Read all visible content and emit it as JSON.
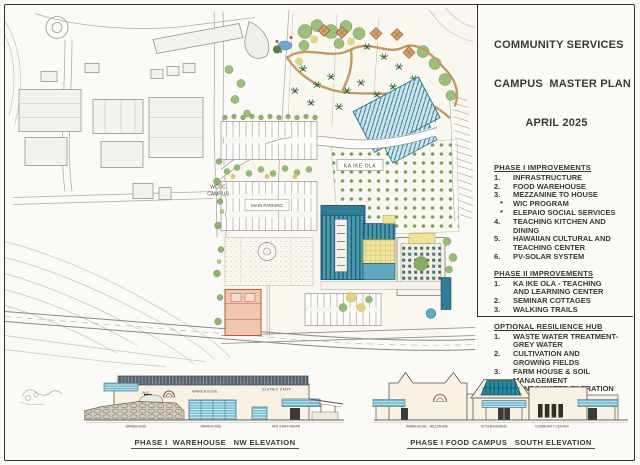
{
  "panel": {
    "title_lines": [
      "COMMUNITY SERVICES",
      "CAMPUS  MASTER PLAN",
      "APRIL 2025"
    ],
    "sections": [
      {
        "heading": "PHASE I IMPROVEMENTS",
        "items": [
          {
            "num": "1.",
            "text": "INFRASTRUCTURE"
          },
          {
            "num": "2.",
            "text": "FOOD WAREHOUSE"
          },
          {
            "num": "3.",
            "text": "MEZZANINE TO HOUSE"
          },
          {
            "num": "*",
            "text": "WIC PROGRAM"
          },
          {
            "num": "*",
            "text": "ELEPAIO SOCIAL SERVICES"
          },
          {
            "num": "4.",
            "text": "TEACHING KITCHEN AND DINING"
          },
          {
            "num": "5.",
            "text": "HAWAIIAN CULTURAL AND TEACHING CENTER"
          },
          {
            "num": "6.",
            "text": "PV-SOLAR SYSTEM"
          }
        ]
      },
      {
        "heading": "PHASE II IMPROVEMENTS",
        "items": [
          {
            "num": "1.",
            "text": "KA IKE OLA - TEACHING AND LEARNING CENTER"
          },
          {
            "num": "2.",
            "text": "SEMINAR COTTAGES"
          },
          {
            "num": "3.",
            "text": "WALKING TRAILS"
          }
        ]
      },
      {
        "heading": "OPTIONAL RESILIENCE HUB",
        "items": [
          {
            "num": "1.",
            "text": "WASTE WATER TREATMENT-GREY WATER"
          },
          {
            "num": "2.",
            "text": "CULTIVATION AND GROWING FIELDS"
          },
          {
            "num": "3.",
            "text": "FARM HOUSE & SOIL MANAGEMENT"
          },
          {
            "num": "4.",
            "text": "PONDS WATER FILTRATION"
          },
          {
            "num": "5.",
            "text": "COMMUNITY CENTER"
          }
        ]
      }
    ]
  },
  "site_plan": {
    "campus_label_line1": "WCCC",
    "campus_label_line2": "CAMPUS",
    "orchard_label": "KA IKE OLA",
    "parking_label": "MAIN PARKING"
  },
  "elevations": {
    "left": {
      "title": "PHASE I  WAREHOUSE   NW ELEVATION",
      "wall_label_wic": "WIC",
      "wall_label_warehouse": "WAREHOUSE",
      "wall_label_elepaio": "ELEPAIO STAFF",
      "base_label_1": "WAREHOUSE",
      "base_label_2": "WAREHOUSE",
      "base_label_3": "HFB  STAFF ADMIN"
    },
    "right": {
      "title": "PHASE I FOOD CAMPUS   SOUTH ELEVATION",
      "base_label_1": "WAREHOUSE - MEZZANINE",
      "base_label_2": "KITCHEN/DINING",
      "base_label_3": "COMMUNITY CENTER"
    }
  },
  "colors": {
    "teal_building": "#4a9cb0",
    "solar_roof": "#57646e",
    "pv_hatch": "#2f7d95",
    "yellow_building": "#efe39a",
    "cottage_tan": "#d8a066",
    "palm_green": "#3e6b33",
    "awning_blue": "#68b4ca",
    "salmon_building": "#f0c6ae",
    "water_blue": "#6aa9d8",
    "ink": "#3b3933"
  }
}
